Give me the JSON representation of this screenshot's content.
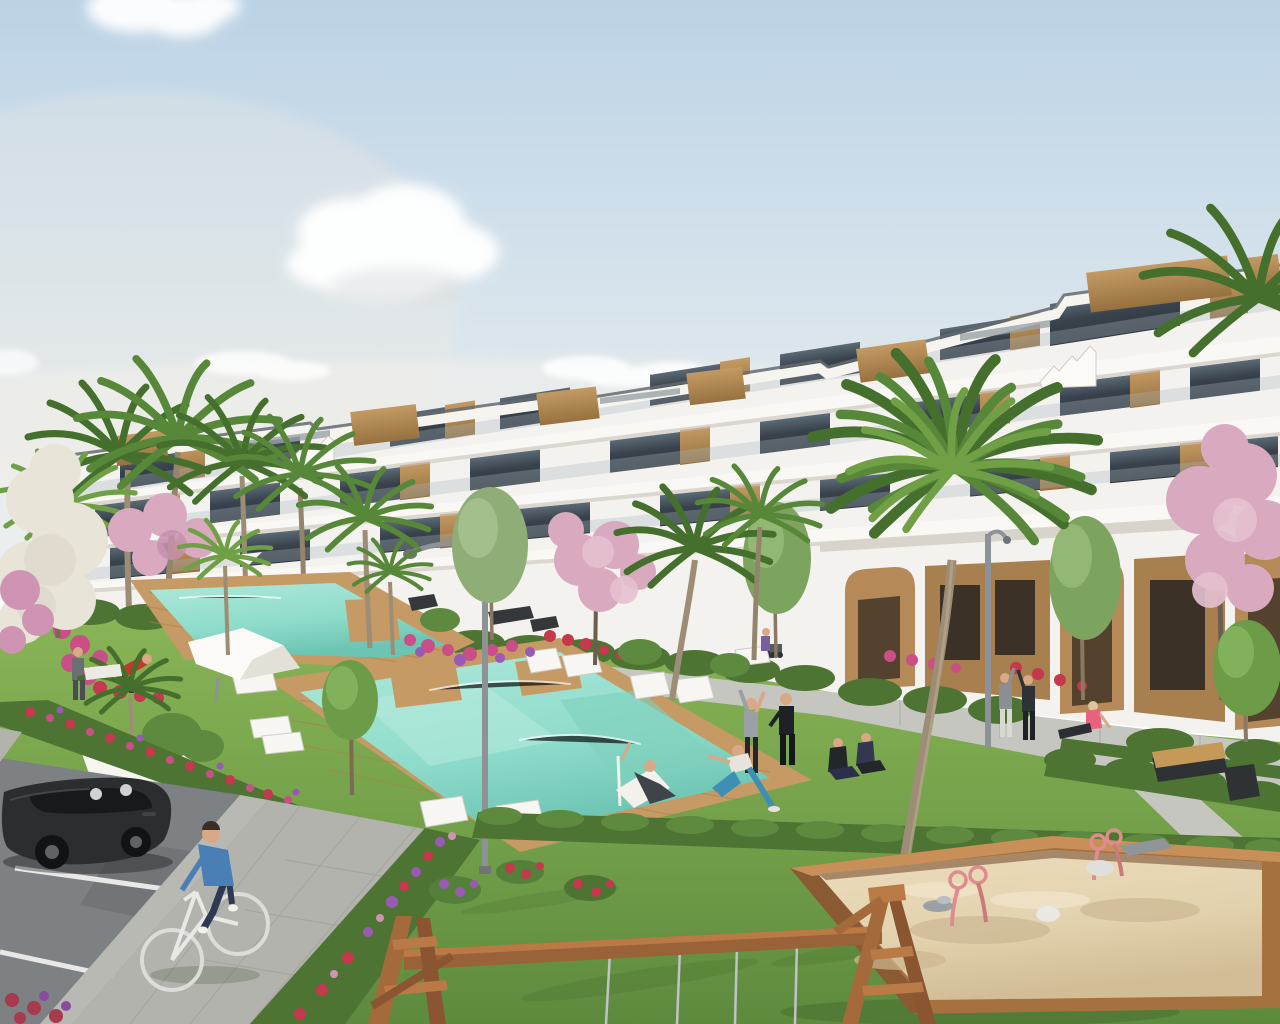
{
  "scene": {
    "title": "Daytime 3D exterior render of a modern white terraced apartment complex with communal pools, lawns, palm trees and a playground",
    "type": "architectural-visualization",
    "time_of_day": "day",
    "palette": {
      "sky_top": "#bcd3e6",
      "sky_mid": "#d8e4ec",
      "sky_horizon": "#edefee",
      "cloud_white": "#ffffff",
      "building_white": "#f4f2ee",
      "slab_white": "#faf8f4",
      "building_shadow": "#cfccc4",
      "glass_top": "#5b6a75",
      "glass_bottom": "#2f363d",
      "roof_rail": "#646b71",
      "wood_light": "#b98f5c",
      "wood_dark": "#96713f",
      "arcade_wood": "#b68a58",
      "grass_light": "#86b254",
      "grass_mid": "#6f9b46",
      "grass_dark": "#55803a",
      "hedge_green": "#4e7433",
      "pool_light": "#9fe0d0",
      "pool_deep": "#6cc4b2",
      "deck_light": "#c59a64",
      "deck_dark": "#a9804e",
      "path_grey": "#c6c6c0",
      "paver_grey": "#b3b3ae",
      "asphalt_grey": "#7e8184",
      "kerb_grey": "#b9b9b4",
      "line_white": "#e8e8e6",
      "sand_light": "#e8d8b6",
      "sand_shade": "#d2bd97",
      "sandbox_wood": "#a5713f",
      "blossom_pink": "#d9a9bf",
      "blossom_pale": "#e6c1d1",
      "blossom_white": "#e9e4d8",
      "flower_red": "#c5384e",
      "flower_magenta": "#c94f86",
      "flower_purple": "#9b59b6",
      "car_body": "#2b2d2f",
      "car_glass": "#17191b",
      "lamp_grey": "#8d9296",
      "lounger_white": "#f7f6f2",
      "trunk_brown": "#9d8d76",
      "palm_green_dark": "#456f2d",
      "palm_green_mid": "#578738",
      "palm_green_light": "#6fa046",
      "skin": "#d9a886",
      "sweater_blue": "#4a7fb5",
      "denim_blue": "#2e3a52",
      "accent_red": "#c0392b",
      "accent_pink": "#e8627e",
      "sport_black": "#1e2226",
      "leggings_blue": "#3f8fb5",
      "spring_rider_pink": "#dd8d8d"
    },
    "building": {
      "storeys": 4,
      "style": "modern white stepped apartment block, rising toward the right",
      "features": [
        "white cantilevered balcony slabs",
        "glass balustrades",
        "dark tinted window walls",
        "timber slat cabins on roof terraces",
        "sculptural white roof stairs",
        "ground-floor arcade with arched openings and timber cladding"
      ]
    },
    "amenities": [
      "large main swimming pool with timber deck",
      "second upper swimming pool",
      "white sun loungers",
      "white shade canopy and parasols",
      "curved street lamps",
      "park benches",
      "walking paths",
      "flower beds and trimmed hedges"
    ],
    "playground": [
      "timber sandbox filled with sand",
      "two pink spring riders",
      "wooden swing frame with metal chains"
    ],
    "vegetation": [
      "canary palms",
      "young deciduous trees",
      "pink blossom trees",
      "white blossom tree",
      "red, magenta and purple flower borders",
      "trimmed hedges"
    ],
    "people": [
      "cyclist in blue sweater on paved path",
      "man reclining on pool deckchair",
      "woman stretching on lawn",
      "man in black sportswear exercising",
      "woman lunging in blue leggings",
      "couple sitting on the grass",
      "two people chatting on promenade",
      "woman in pink sitting on path",
      "person with stroller",
      "two men talking near upper pool"
    ],
    "vehicles": [
      "dark grey hatchback parked in marked stall"
    ],
    "clouds": 6
  }
}
